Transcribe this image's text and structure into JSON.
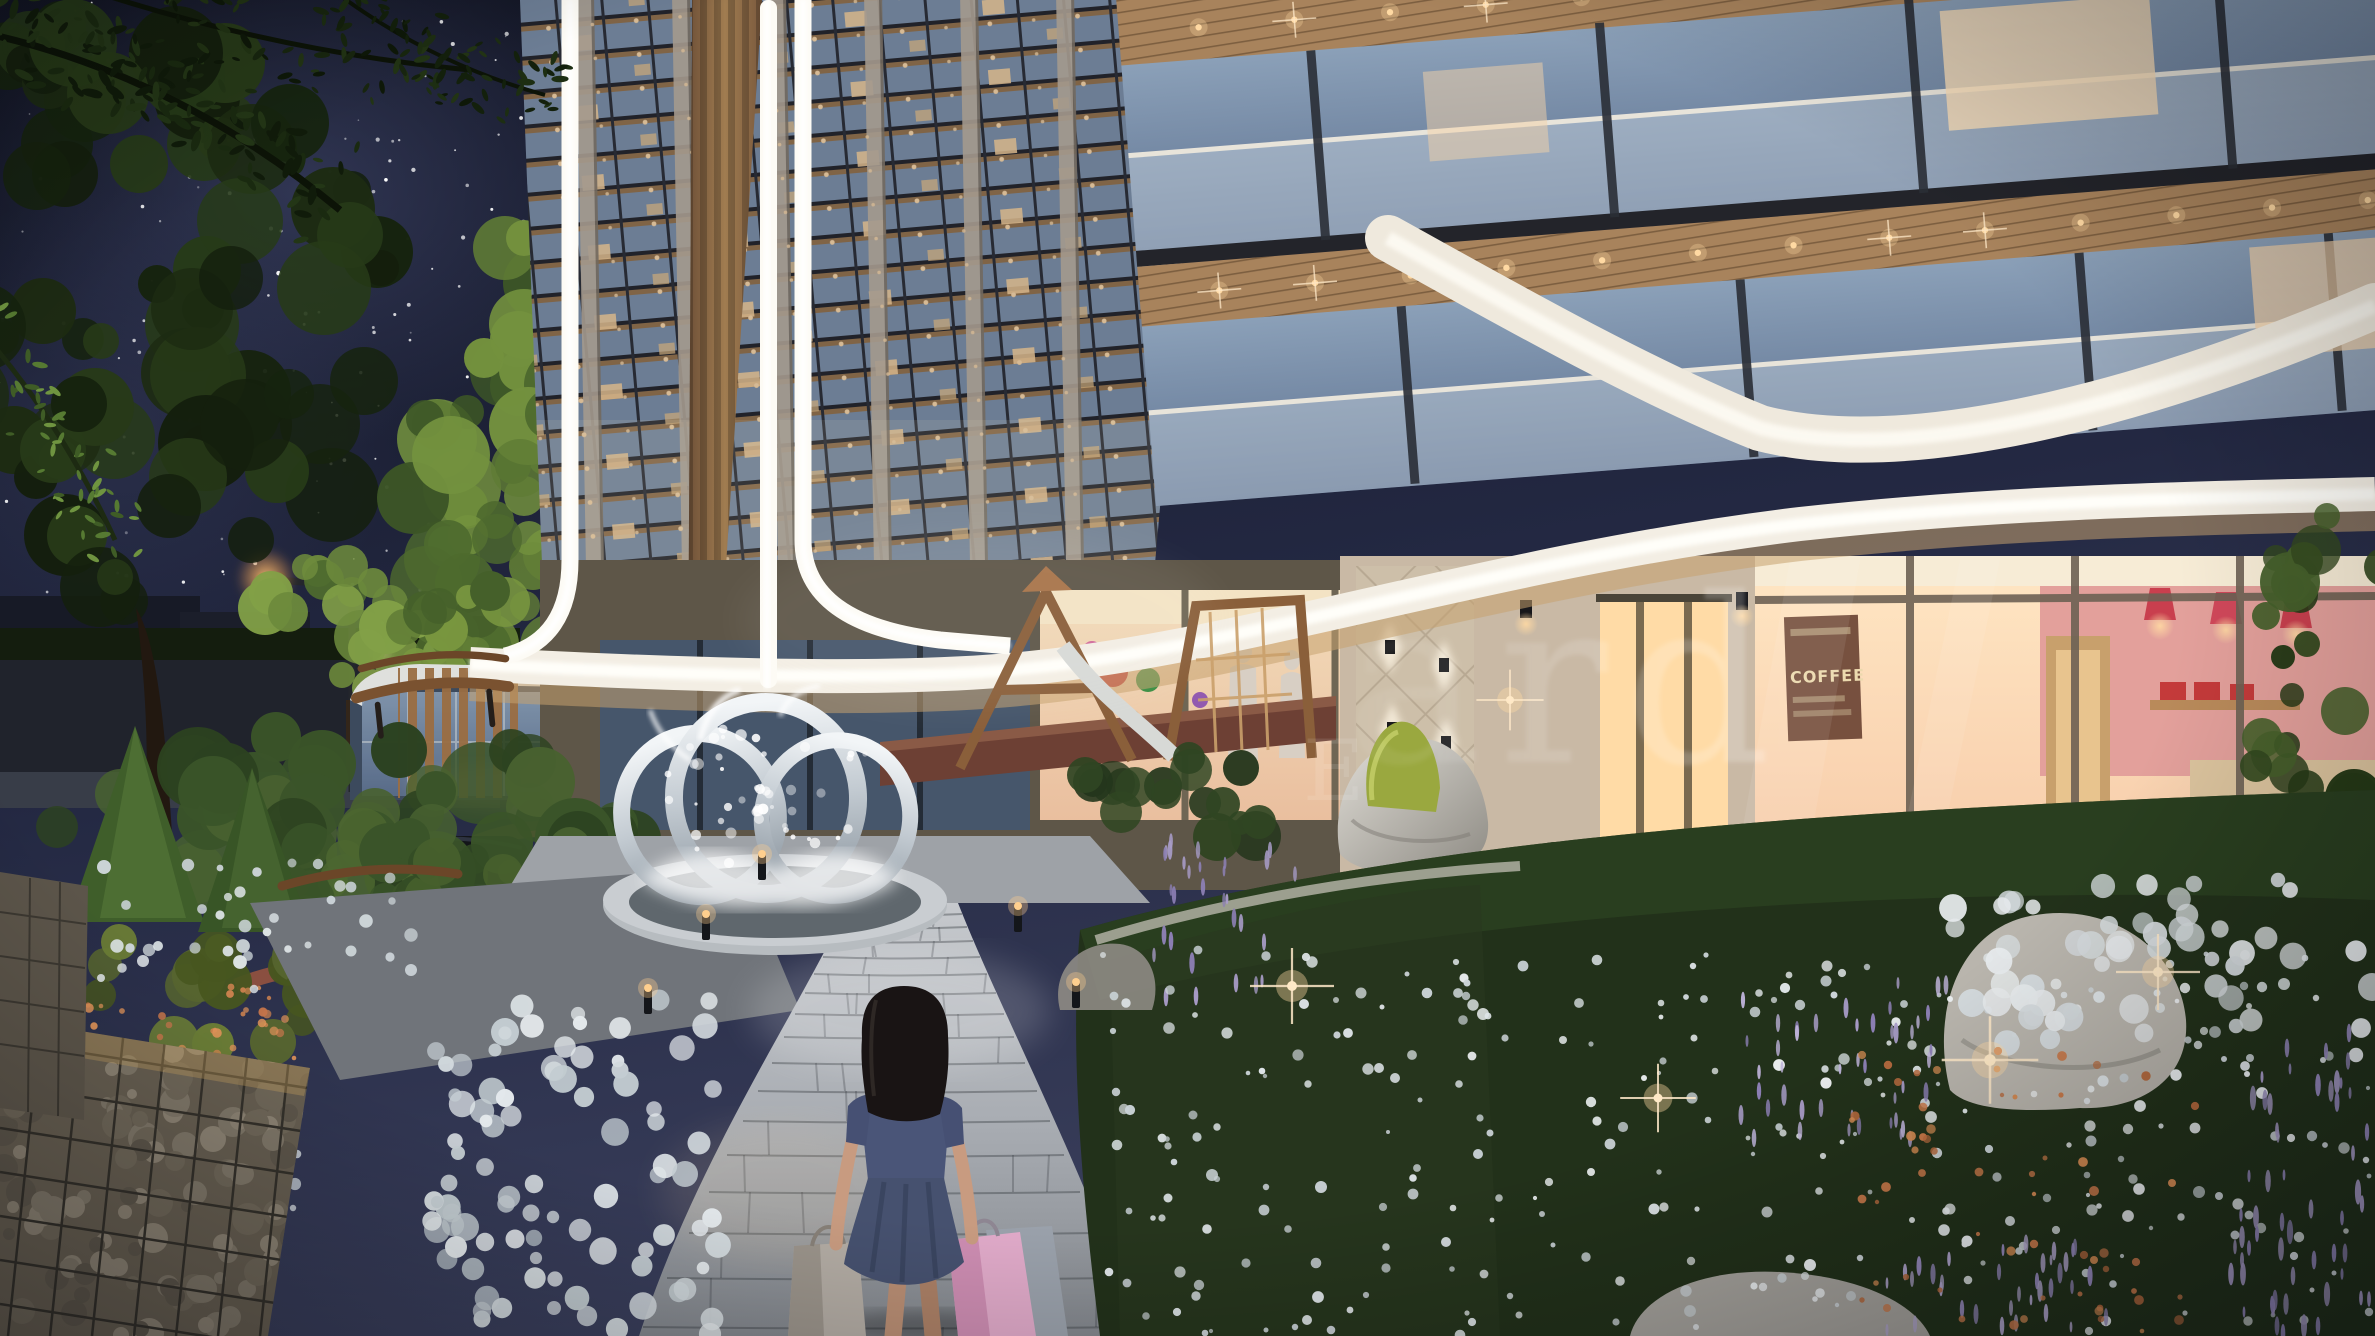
{
  "meta": {
    "scene": "Night-time architectural rendering of a residential complex courtyard",
    "width_px": 2375,
    "height_px": 1336,
    "time_of_day": "night"
  },
  "watermark": {
    "fragment": "ard",
    "secondary_fragment": "E"
  },
  "cafe_wall_art": {
    "word": "COFFEE"
  },
  "palette": {
    "sky_top": "#141726",
    "sky_bottom": "#2a2f4a",
    "facade_stone": "#b9aa99",
    "facade_copper": "#8a6645",
    "wood_soffit": "#a8835c",
    "glass_cool": "#8299b4",
    "window_warm": "#ffd9a3",
    "led_white": "#fdfbf5",
    "canopy_white": "#f3eee4",
    "foliage_dark": "#1c2b12",
    "foliage_lit": "#7f9f47",
    "flower_white": "#e6eaec",
    "flower_purple": "#a79bc6",
    "flower_orange": "#c8794a",
    "path_pavers": "#b9bdc2",
    "girl_dress": "#4a5578",
    "bag_pink": "#e0aac9",
    "bag_gray": "#b3aca4",
    "street_lamp_glow": "#ffb25e"
  }
}
